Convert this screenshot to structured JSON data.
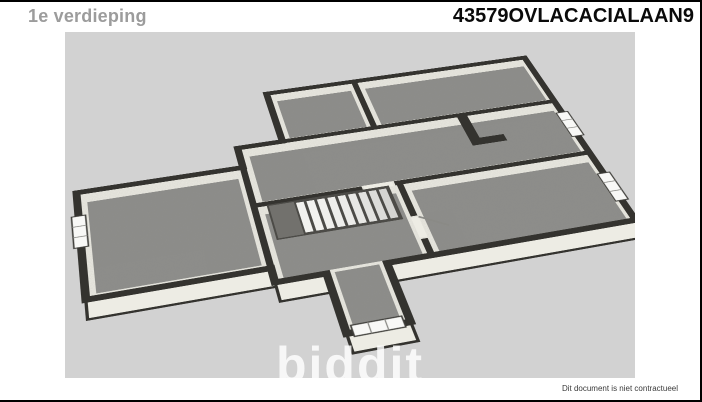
{
  "header": {
    "floor_label": "1e verdieping",
    "title": "43579OVLACACIALAAN9"
  },
  "watermark": {
    "brand": "biddit"
  },
  "footer": {
    "disclaimer": "Dit document is niet contractueel"
  },
  "floor_plan": {
    "view": "3d-top-down-floorplan",
    "floor": "1e verdieping",
    "rooms_visible": 7,
    "staircase": true,
    "window_count": 4,
    "icons": [
      "window-icon",
      "staircase-icon",
      "door-icon"
    ]
  },
  "colors": {
    "page_bg": "#ffffff",
    "canvas_bg": "#d2d2d2",
    "wall": "#34332f",
    "wall_face": "#edece4",
    "floor_carpet": "#8e8e8b",
    "stair_tread": "#f2f2ef",
    "floor_label_text": "#9c9c9c",
    "title_text": "#0a0a0a",
    "watermark_text": "rgba(255,255,255,0.82)",
    "disclaimer_text": "#3a3a3a"
  }
}
